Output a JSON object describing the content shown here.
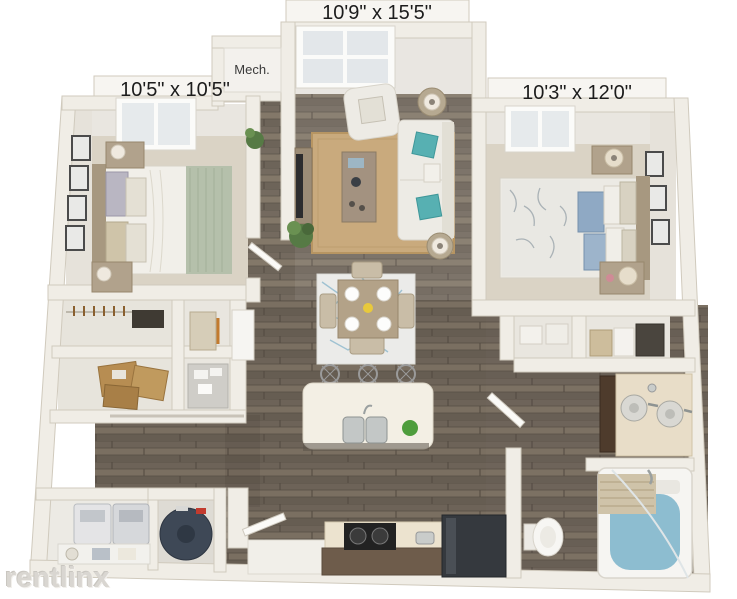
{
  "floorplan": {
    "rooms": {
      "living_dining": {
        "dimensions": "10'9\" x 15'5\""
      },
      "bedroom_left": {
        "dimensions": "10'5\" x 10'5\""
      },
      "bedroom_right": {
        "dimensions": "10'3\" x 12'0\""
      },
      "mech_closet": {
        "label": "Mech."
      }
    },
    "watermark": {
      "text": "rentlinx"
    },
    "colors": {
      "background": "#ffffff",
      "wall": "#f0ede6",
      "hardwood": "#7a7065",
      "carpet": "#dad3c5",
      "jute_rug": "#c9aa7d",
      "accent_teal": "#57b0b2",
      "tub_water": "#8dbdd0",
      "label_text": "#1c1c1c"
    }
  }
}
